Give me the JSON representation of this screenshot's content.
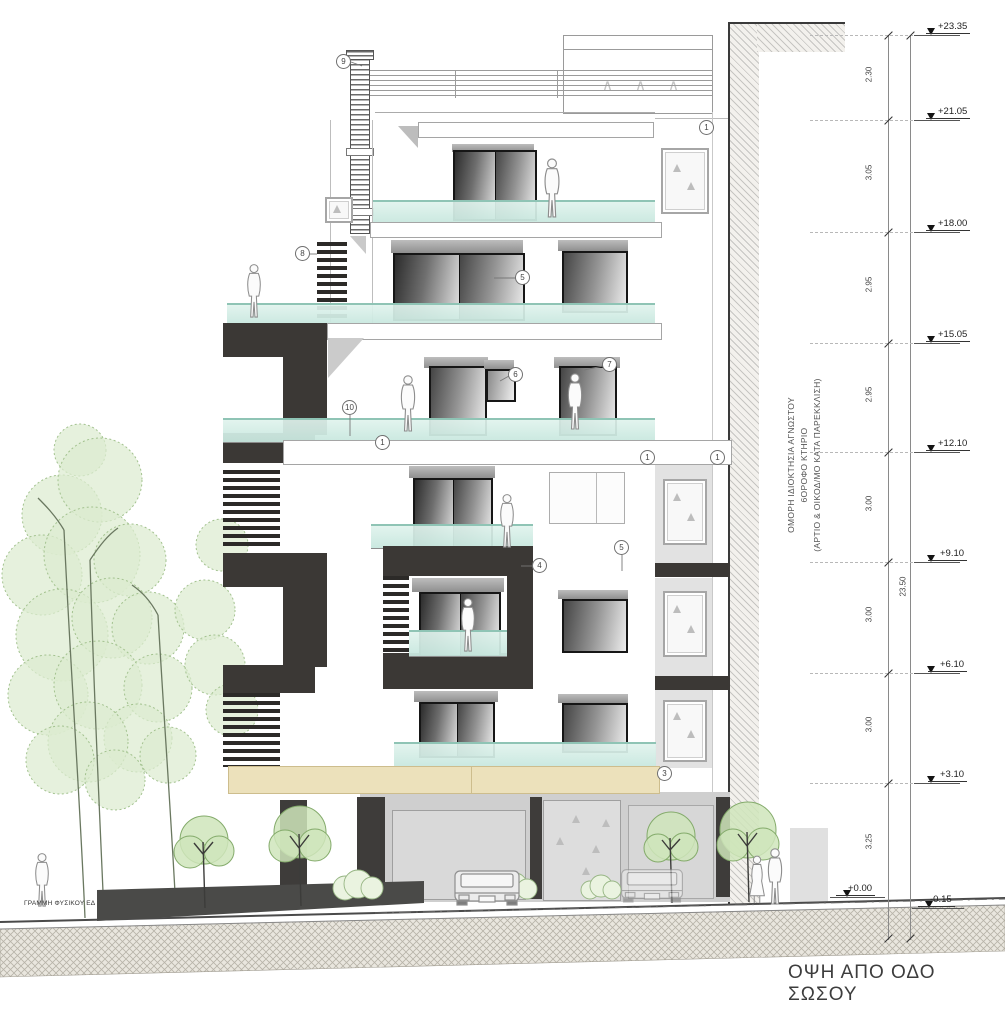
{
  "drawing": {
    "title": "ΟΨΗ ΑΠΟ ΟΔΟ ΣΩΣΟΥ",
    "ground_line_label": "ΓΡΑΜΜΗ ΦΥΣΙΚΟΥ ΕΔ",
    "adjacent_property_note": {
      "line1": "ΟΜΟΡΗ ΙΔΙΟΚΤΗΣΙΑ ΑΓΝΩΣΤΟΥ",
      "line2": "6ΟΡΟΦΟ ΚΤΗΡΙΟ",
      "line3": "(ΑΡΤΙΟ & ΟΙΚΟΔ/ΜΟ ΚΑΤΑ ΠΑΡΕΚΚΛΙΣΗ)"
    },
    "roof_vent_marks": [
      "∧",
      "∧",
      "∧"
    ]
  },
  "dimensions": {
    "levels": [
      {
        "label": "+23.35"
      },
      {
        "label": "+21.05"
      },
      {
        "label": "+18.00"
      },
      {
        "label": "+15.05"
      },
      {
        "label": "+12.10"
      },
      {
        "label": "+9.10"
      },
      {
        "label": "+6.10"
      },
      {
        "label": "+3.10"
      },
      {
        "label": "+0.00"
      },
      {
        "label": "-0.15"
      }
    ],
    "segments": [
      {
        "label": "2.30"
      },
      {
        "label": "3.05"
      },
      {
        "label": "2.95"
      },
      {
        "label": "2.95"
      },
      {
        "label": "3.00"
      },
      {
        "label": "3.00"
      },
      {
        "label": "3.00"
      },
      {
        "label": "3.25"
      }
    ],
    "total": "23.50"
  },
  "callouts": [
    {
      "n": "9"
    },
    {
      "n": "1"
    },
    {
      "n": "8"
    },
    {
      "n": "5"
    },
    {
      "n": "7"
    },
    {
      "n": "6"
    },
    {
      "n": "10"
    },
    {
      "n": "1"
    },
    {
      "n": "1"
    },
    {
      "n": "1"
    },
    {
      "n": "5"
    },
    {
      "n": "4"
    },
    {
      "n": "3"
    }
  ],
  "colors": {
    "glass": "#cfe9e0",
    "dark_panel": "#3b3835",
    "canopy_beige": "#ece1bb",
    "foliage_green": "#a9c795",
    "earth_hatch": "#b7b3a8"
  }
}
